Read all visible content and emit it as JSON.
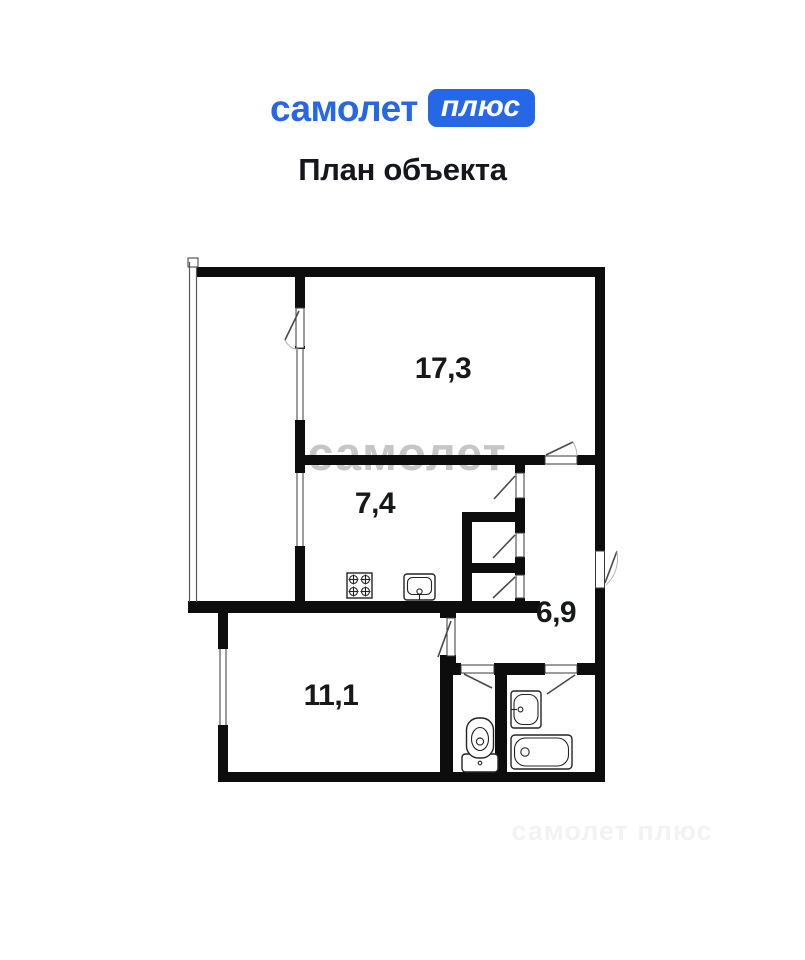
{
  "header": {
    "logo_text": "самолет",
    "logo_badge": "плюс",
    "title": "План объекта",
    "brand_blue": "#2667e8"
  },
  "watermark": {
    "center": "самолет",
    "bottom": "самолет плюс"
  },
  "plan": {
    "rooms": [
      {
        "name": "room-17-3",
        "area_label": "17,3"
      },
      {
        "name": "room-7-4",
        "area_label": "7,4"
      },
      {
        "name": "room-6-9",
        "area_label": "6,9"
      },
      {
        "name": "room-11-1",
        "area_label": "11,1"
      }
    ],
    "fixtures": [
      "stove-icon",
      "kitchen-sink-icon",
      "toilet-icon",
      "wash-basin-icon",
      "bathtub-icon"
    ]
  }
}
